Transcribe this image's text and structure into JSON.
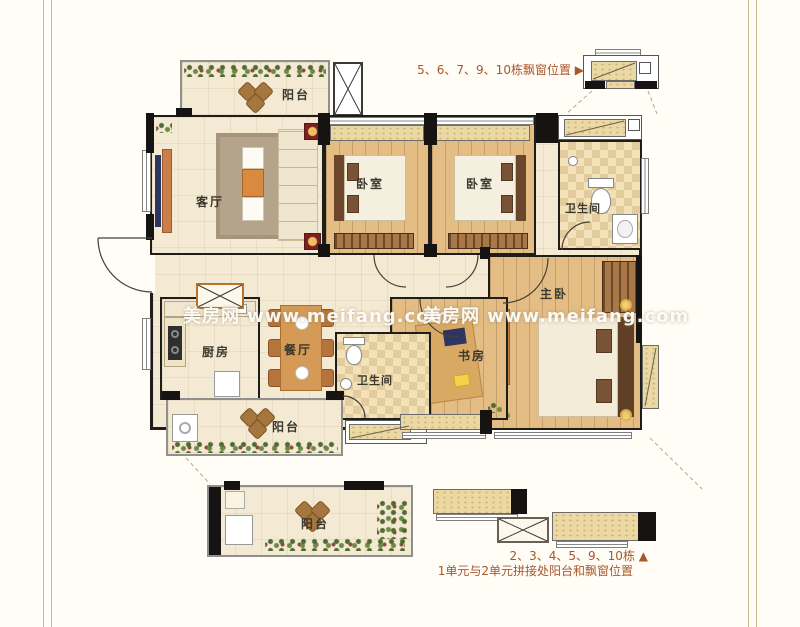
{
  "colors": {
    "annotation": "#a9572b",
    "frame_line": "#cdb793",
    "wall": "#161412"
  },
  "watermarks": [
    {
      "text": "美房网 www.meifang.com"
    },
    {
      "text": "美房网 www.meifang.com"
    }
  ],
  "rooms": {
    "balcony_top": {
      "label": "阳台"
    },
    "living_room": {
      "label": "客厅"
    },
    "bedroom_left": {
      "label": "卧室"
    },
    "bedroom_right": {
      "label": "卧室"
    },
    "bathroom_top": {
      "label": "卫生间"
    },
    "master_bedroom": {
      "label": "主卧"
    },
    "study": {
      "label": "书房"
    },
    "kitchen": {
      "label": "厨房"
    },
    "dining_room": {
      "label": "餐厅"
    },
    "bathroom_bottom": {
      "label": "卫生间"
    },
    "balcony_bottom": {
      "label": "阳台"
    },
    "balcony_detail": {
      "label": "阳台"
    }
  },
  "annotations": {
    "top_right": "5、6、7、9、10栋飘窗位置 ▶",
    "bottom_line1": "2、3、4、5、9、10栋 ▲",
    "bottom_line2": "1单元与2单元拼接处阳台和飘窗位置"
  }
}
